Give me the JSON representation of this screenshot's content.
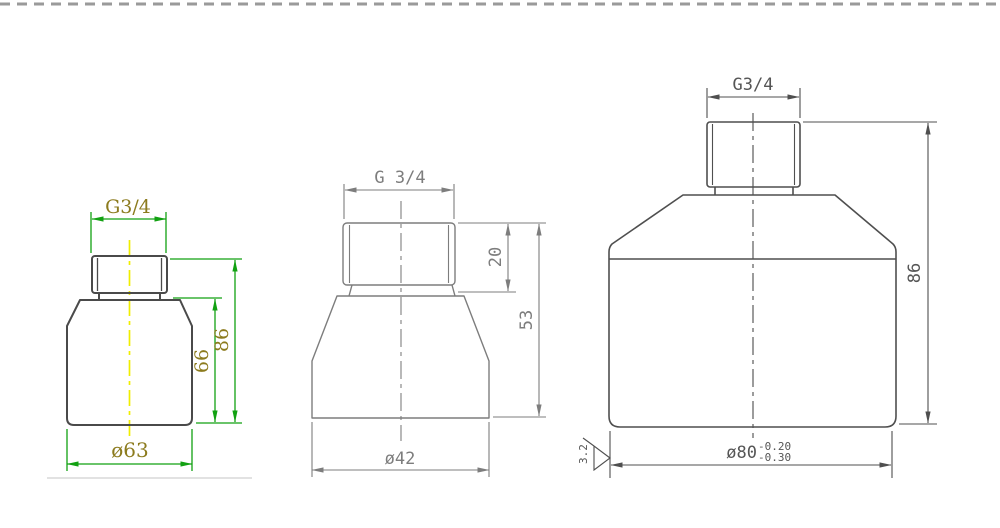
{
  "drawings": {
    "left": {
      "thread_label": "G3/4",
      "total_height": "86",
      "body_height": "66",
      "diameter": "ø63"
    },
    "middle": {
      "thread_label": "G 3/4",
      "thread_height": "20",
      "total_height": "53",
      "diameter": "ø42"
    },
    "right": {
      "thread_label": "G3/4",
      "total_height": "86",
      "diameter": "ø80",
      "tolerance_upper": "-0.20",
      "tolerance_lower": "-0.30",
      "surface_roughness": "3.2"
    }
  },
  "colors": {
    "left_outline": "#4a4a4a",
    "left_dimension_lines": "#12a112",
    "left_text": "#8c7b1e",
    "left_centerline": "#f0ee00",
    "middle_lines": "#7d7d7d",
    "right_lines": "#4f4f4f",
    "top_border_dashes": "#9a9a9a"
  }
}
